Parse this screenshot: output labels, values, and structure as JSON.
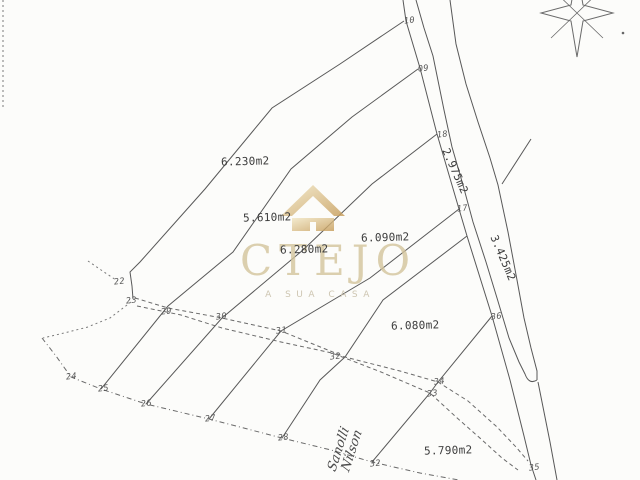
{
  "watermark": {
    "brand": "CTEJO",
    "tagline": "A SUA CASA",
    "brand_color": "#d3c49c",
    "house_color_light": "#f2e7c4",
    "house_color_dark": "#c59a55"
  },
  "parcels": [
    {
      "area_label": "6.230m2"
    },
    {
      "area_label": "5.610m2"
    },
    {
      "area_label": "6.280m2"
    },
    {
      "area_label": "6.090m2"
    },
    {
      "area_label": "6.080m2"
    },
    {
      "area_label": "5.790m2"
    }
  ],
  "road_strips": [
    {
      "area_label": "2.975m2"
    },
    {
      "area_label": "3.425m2"
    }
  ],
  "survey_points": [
    {
      "id": "10"
    },
    {
      "id": "09"
    },
    {
      "id": "18"
    },
    {
      "id": "17"
    },
    {
      "id": "36"
    },
    {
      "id": "35"
    },
    {
      "id": "22"
    },
    {
      "id": "23"
    },
    {
      "id": "29"
    },
    {
      "id": "30"
    },
    {
      "id": "31"
    },
    {
      "id": "32"
    },
    {
      "id": "33"
    },
    {
      "id": "34"
    },
    {
      "id": "24"
    },
    {
      "id": "25"
    },
    {
      "id": "26"
    },
    {
      "id": "27"
    },
    {
      "id": "28"
    },
    {
      "id": "32"
    }
  ],
  "handwriting": {
    "line1": "Sanolli",
    "line2": "Nilson"
  },
  "colors": {
    "paper": "#fcfcfa",
    "line": "#585858"
  }
}
